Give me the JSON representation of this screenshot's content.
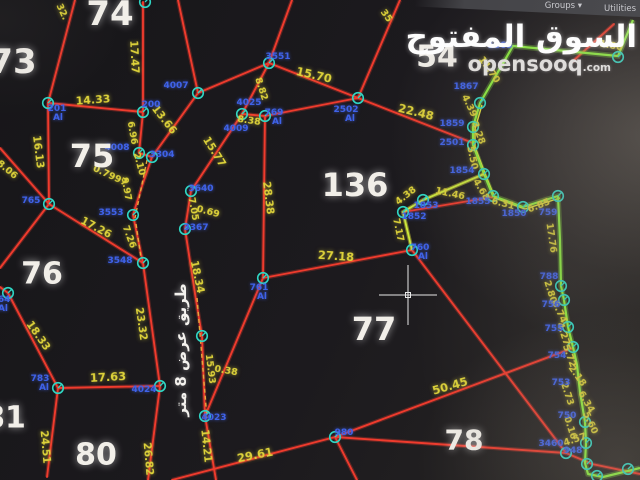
{
  "toolbar": {
    "groups_label": "Groups ▾",
    "utilities_label": "Utilities"
  },
  "watermark": {
    "arabic": "السوق المفتوح",
    "latin": "opensooq",
    "tld": ".com"
  },
  "colors": {
    "parcel_line": "#ef3b2d",
    "highlight_boundary": "#8df23e",
    "highlight_inner": "#e6e63a",
    "distance_label": "#ddd23a",
    "point_label": "#3f62e8",
    "point_marker": "#2fd6c4",
    "parcel_number": "#f2efe9",
    "road_dash": "#e8a83c",
    "crosshair": "#e8e8e8"
  },
  "map": {
    "road_label": {
      "t": "طريق عرض 8 متر",
      "x": 181,
      "y": 350,
      "size": 15
    },
    "crosshair": {
      "x": 408,
      "y": 295
    },
    "parcel_numbers": [
      {
        "t": "73",
        "x": 13,
        "y": 62,
        "s": 34
      },
      {
        "t": "74",
        "x": 110,
        "y": 14,
        "s": 34
      },
      {
        "t": "75",
        "x": 92,
        "y": 156,
        "s": 32
      },
      {
        "t": "76",
        "x": 42,
        "y": 274,
        "s": 30
      },
      {
        "t": "54",
        "x": 437,
        "y": 57,
        "s": 30
      },
      {
        "t": "136",
        "x": 355,
        "y": 185,
        "s": 32
      },
      {
        "t": "77",
        "x": 374,
        "y": 329,
        "s": 32
      },
      {
        "t": "78",
        "x": 464,
        "y": 440,
        "s": 28
      },
      {
        "t": "80",
        "x": 96,
        "y": 455,
        "s": 30
      },
      {
        "t": "81",
        "x": 5,
        "y": 418,
        "s": 30
      }
    ],
    "distance_labels": [
      {
        "t": "32.",
        "x": 62,
        "y": 12,
        "r": 65
      },
      {
        "t": "17.47",
        "x": 134,
        "y": 57,
        "r": 87,
        "s": 10.5
      },
      {
        "t": "14.33",
        "x": 93,
        "y": 100,
        "r": -4,
        "s": 11
      },
      {
        "t": "16.13",
        "x": 38,
        "y": 152,
        "r": 83,
        "s": 10.5
      },
      {
        "t": "8.06",
        "x": 7,
        "y": 170,
        "r": 40
      },
      {
        "t": "6.96",
        "x": 132,
        "y": 133,
        "r": 80
      },
      {
        "t": "2.10",
        "x": 139,
        "y": 164,
        "r": 75
      },
      {
        "t": "0.7997",
        "x": 110,
        "y": 176,
        "r": 25
      },
      {
        "t": "9.97",
        "x": 126,
        "y": 189,
        "r": 80
      },
      {
        "t": "13.66",
        "x": 164,
        "y": 120,
        "r": 52,
        "s": 10.5
      },
      {
        "t": "8.82",
        "x": 261,
        "y": 89,
        "r": 72
      },
      {
        "t": "15.70",
        "x": 314,
        "y": 75,
        "r": 13,
        "s": 11.5
      },
      {
        "t": "35",
        "x": 386,
        "y": 16,
        "r": 55
      },
      {
        "t": "22.48",
        "x": 416,
        "y": 112,
        "r": 14,
        "s": 11.5
      },
      {
        "t": "8.38",
        "x": 249,
        "y": 121,
        "r": 8
      },
      {
        "t": "15.77",
        "x": 214,
        "y": 152,
        "r": 58,
        "s": 10.5
      },
      {
        "t": "7.05",
        "x": 193,
        "y": 209,
        "r": 80
      },
      {
        "t": "0.69",
        "x": 208,
        "y": 212,
        "r": 15
      },
      {
        "t": "28.38",
        "x": 268,
        "y": 198,
        "r": 83,
        "s": 10.5
      },
      {
        "t": "17.26",
        "x": 96,
        "y": 228,
        "r": 28,
        "s": 10.5
      },
      {
        "t": "7.26",
        "x": 129,
        "y": 237,
        "r": 70
      },
      {
        "t": "18.33",
        "x": 38,
        "y": 336,
        "r": 55,
        "s": 10.5
      },
      {
        "t": "17.63",
        "x": 108,
        "y": 377,
        "r": -3,
        "s": 11.5
      },
      {
        "t": "24.51",
        "x": 45,
        "y": 447,
        "r": 85,
        "s": 10.5
      },
      {
        "t": "23.32",
        "x": 141,
        "y": 324,
        "r": 82,
        "s": 10.5
      },
      {
        "t": "26.82",
        "x": 148,
        "y": 459,
        "r": 85,
        "s": 10.5
      },
      {
        "t": "18.34",
        "x": 197,
        "y": 277,
        "r": 78,
        "s": 10.5
      },
      {
        "t": "15.93",
        "x": 210,
        "y": 369,
        "r": 83
      },
      {
        "t": "0.38",
        "x": 226,
        "y": 371,
        "r": 10
      },
      {
        "t": "14.21",
        "x": 206,
        "y": 446,
        "r": 84,
        "s": 10.5
      },
      {
        "t": "29.61",
        "x": 255,
        "y": 455,
        "r": -11,
        "s": 11.5
      },
      {
        "t": "27.18",
        "x": 336,
        "y": 256,
        "r": 4,
        "s": 11.5
      },
      {
        "t": "50.45",
        "x": 450,
        "y": 386,
        "r": -16,
        "s": 11.5
      },
      {
        "t": "11.70",
        "x": 489,
        "y": 70,
        "r": 55
      },
      {
        "t": "4.39",
        "x": 469,
        "y": 106,
        "r": 65
      },
      {
        "t": "3.28",
        "x": 478,
        "y": 133,
        "r": 70
      },
      {
        "t": "5.50",
        "x": 472,
        "y": 158,
        "r": 78
      },
      {
        "t": "4.68",
        "x": 481,
        "y": 190,
        "r": 60
      },
      {
        "t": "6.31",
        "x": 503,
        "y": 204,
        "r": 14
      },
      {
        "t": "6.85",
        "x": 539,
        "y": 206,
        "r": -22
      },
      {
        "t": "17.76",
        "x": 551,
        "y": 238,
        "r": 82
      },
      {
        "t": "11.46",
        "x": 450,
        "y": 194,
        "r": 12
      },
      {
        "t": "4.38",
        "x": 406,
        "y": 196,
        "r": -38
      },
      {
        "t": "7.17",
        "x": 398,
        "y": 230,
        "r": 78
      },
      {
        "t": "2.80",
        "x": 550,
        "y": 292,
        "r": 73
      },
      {
        "t": "6.74",
        "x": 559,
        "y": 312,
        "r": 65
      },
      {
        "t": "4.27",
        "x": 563,
        "y": 334,
        "r": 72
      },
      {
        "t": "5.72",
        "x": 569,
        "y": 356,
        "r": 70
      },
      {
        "t": "2.18",
        "x": 577,
        "y": 376,
        "r": 55
      },
      {
        "t": "2.73",
        "x": 567,
        "y": 394,
        "r": 72
      },
      {
        "t": "6.34",
        "x": 586,
        "y": 402,
        "r": 60
      },
      {
        "t": "5.60",
        "x": 590,
        "y": 423,
        "r": 65
      },
      {
        "t": "0.16",
        "x": 570,
        "y": 428,
        "r": 72
      },
      {
        "t": "4.57",
        "x": 575,
        "y": 440,
        "r": -18
      },
      {
        "t": "1.80",
        "x": 611,
        "y": 46,
        "r": 10
      }
    ],
    "point_labels": [
      {
        "t": "201",
        "x": 57,
        "y": 109
      },
      {
        "t": "Al",
        "x": 58,
        "y": 118
      },
      {
        "t": "200",
        "x": 151,
        "y": 105
      },
      {
        "t": "4007",
        "x": 176,
        "y": 86
      },
      {
        "t": "3551",
        "x": 278,
        "y": 57
      },
      {
        "t": "2502",
        "x": 346,
        "y": 110
      },
      {
        "t": "Al",
        "x": 350,
        "y": 119
      },
      {
        "t": "4025",
        "x": 249,
        "y": 103
      },
      {
        "t": "769",
        "x": 274,
        "y": 113
      },
      {
        "t": "Al",
        "x": 277,
        "y": 122
      },
      {
        "t": "4009",
        "x": 236,
        "y": 129
      },
      {
        "t": "3640",
        "x": 201,
        "y": 189
      },
      {
        "t": "3367",
        "x": 196,
        "y": 228
      },
      {
        "t": "4008",
        "x": 117,
        "y": 148
      },
      {
        "t": "3304",
        "x": 162,
        "y": 155
      },
      {
        "t": "3553",
        "x": 111,
        "y": 213
      },
      {
        "t": "3548",
        "x": 120,
        "y": 261
      },
      {
        "t": "765",
        "x": 31,
        "y": 201
      },
      {
        "t": "764",
        "x": 1,
        "y": 300
      },
      {
        "t": "Al",
        "x": 3,
        "y": 309
      },
      {
        "t": "761",
        "x": 259,
        "y": 288
      },
      {
        "t": "Al",
        "x": 262,
        "y": 297
      },
      {
        "t": "783",
        "x": 40,
        "y": 379
      },
      {
        "t": "Al",
        "x": 44,
        "y": 388
      },
      {
        "t": "4024",
        "x": 144,
        "y": 390
      },
      {
        "t": "4023",
        "x": 214,
        "y": 418
      },
      {
        "t": "980",
        "x": 344,
        "y": 433
      },
      {
        "t": "760",
        "x": 420,
        "y": 248
      },
      {
        "t": "Al",
        "x": 423,
        "y": 257
      },
      {
        "t": "2501",
        "x": 452,
        "y": 143
      },
      {
        "t": "1859",
        "x": 452,
        "y": 124
      },
      {
        "t": "1867",
        "x": 466,
        "y": 87
      },
      {
        "t": "1863",
        "x": 500,
        "y": 46
      },
      {
        "t": "1854",
        "x": 462,
        "y": 171
      },
      {
        "t": "1855",
        "x": 478,
        "y": 202
      },
      {
        "t": "1850",
        "x": 514,
        "y": 214
      },
      {
        "t": "759",
        "x": 548,
        "y": 213
      },
      {
        "t": "1853",
        "x": 426,
        "y": 206
      },
      {
        "t": "1852",
        "x": 414,
        "y": 217
      },
      {
        "t": "788",
        "x": 549,
        "y": 277
      },
      {
        "t": "756",
        "x": 551,
        "y": 305
      },
      {
        "t": "755",
        "x": 554,
        "y": 329
      },
      {
        "t": "754",
        "x": 557,
        "y": 356
      },
      {
        "t": "753",
        "x": 561,
        "y": 383
      },
      {
        "t": "750",
        "x": 567,
        "y": 416
      },
      {
        "t": "3460",
        "x": 551,
        "y": 444
      },
      {
        "t": "948",
        "x": 573,
        "y": 451
      }
    ],
    "markers": [
      [
        145,
        2
      ],
      [
        48,
        103
      ],
      [
        143,
        112
      ],
      [
        198,
        93
      ],
      [
        269,
        63
      ],
      [
        358,
        98
      ],
      [
        242,
        114
      ],
      [
        265,
        116
      ],
      [
        139,
        153
      ],
      [
        152,
        157
      ],
      [
        133,
        215
      ],
      [
        143,
        263
      ],
      [
        49,
        204
      ],
      [
        8,
        293
      ],
      [
        191,
        191
      ],
      [
        185,
        229
      ],
      [
        263,
        278
      ],
      [
        58,
        388
      ],
      [
        160,
        386
      ],
      [
        202,
        336
      ],
      [
        205,
        416
      ],
      [
        335,
        437
      ],
      [
        412,
        250
      ],
      [
        403,
        212
      ],
      [
        423,
        200
      ],
      [
        473,
        127
      ],
      [
        473,
        145
      ],
      [
        480,
        103
      ],
      [
        484,
        174
      ],
      [
        493,
        196
      ],
      [
        523,
        207
      ],
      [
        558,
        196
      ],
      [
        618,
        57
      ],
      [
        561,
        286
      ],
      [
        564,
        300
      ],
      [
        568,
        327
      ],
      [
        573,
        347
      ],
      [
        585,
        422
      ],
      [
        586,
        443
      ],
      [
        566,
        453
      ],
      [
        587,
        464
      ],
      [
        597,
        476
      ],
      [
        628,
        469
      ]
    ],
    "red_lines": [
      [
        [
          75,
          0
        ],
        [
          48,
          103
        ]
      ],
      [
        [
          48,
          103
        ],
        [
          143,
          112
        ]
      ],
      [
        [
          48,
          103
        ],
        [
          49,
          204
        ]
      ],
      [
        [
          0,
          148
        ],
        [
          49,
          204
        ]
      ],
      [
        [
          49,
          204
        ],
        [
          0,
          268
        ]
      ],
      [
        [
          49,
          204
        ],
        [
          143,
          263
        ]
      ],
      [
        [
          143,
          2
        ],
        [
          143,
          112
        ]
      ],
      [
        [
          143,
          112
        ],
        [
          139,
          153
        ]
      ],
      [
        [
          139,
          153
        ],
        [
          152,
          157
        ]
      ],
      [
        [
          152,
          157
        ],
        [
          142,
          186
        ],
        [
          133,
          215
        ]
      ],
      [
        [
          133,
          215
        ],
        [
          143,
          263
        ]
      ],
      [
        [
          143,
          263
        ],
        [
          160,
          386
        ]
      ],
      [
        [
          160,
          386
        ],
        [
          148,
          480
        ]
      ],
      [
        [
          152,
          157
        ],
        [
          198,
          93
        ]
      ],
      [
        [
          198,
          93
        ],
        [
          178,
          0
        ]
      ],
      [
        [
          198,
          93
        ],
        [
          269,
          63
        ]
      ],
      [
        [
          269,
          63
        ],
        [
          292,
          0
        ]
      ],
      [
        [
          269,
          63
        ],
        [
          242,
          114
        ]
      ],
      [
        [
          242,
          114
        ],
        [
          191,
          191
        ]
      ],
      [
        [
          191,
          191
        ],
        [
          185,
          229
        ]
      ],
      [
        [
          185,
          229
        ],
        [
          196,
          300
        ],
        [
          202,
          336
        ],
        [
          205,
          416
        ]
      ],
      [
        [
          205,
          416
        ],
        [
          216,
          480
        ]
      ],
      [
        [
          242,
          114
        ],
        [
          265,
          116
        ]
      ],
      [
        [
          265,
          116
        ],
        [
          263,
          278
        ]
      ],
      [
        [
          265,
          116
        ],
        [
          358,
          98
        ]
      ],
      [
        [
          269,
          63
        ],
        [
          358,
          98
        ]
      ],
      [
        [
          358,
          98
        ],
        [
          400,
          0
        ]
      ],
      [
        [
          358,
          98
        ],
        [
          473,
          143
        ]
      ],
      [
        [
          263,
          278
        ],
        [
          412,
          250
        ]
      ],
      [
        [
          263,
          278
        ],
        [
          205,
          416
        ]
      ],
      [
        [
          8,
          293
        ],
        [
          58,
          388
        ]
      ],
      [
        [
          58,
          388
        ],
        [
          160,
          386
        ]
      ],
      [
        [
          58,
          388
        ],
        [
          47,
          477
        ]
      ],
      [
        [
          0,
          287
        ],
        [
          8,
          293
        ]
      ],
      [
        [
          172,
          480
        ],
        [
          335,
          437
        ]
      ],
      [
        [
          335,
          437
        ],
        [
          357,
          480
        ]
      ],
      [
        [
          335,
          437
        ],
        [
          573,
          348
        ]
      ],
      [
        [
          335,
          437
        ],
        [
          566,
          453
        ]
      ],
      [
        [
          412,
          250
        ],
        [
          566,
          453
        ]
      ],
      [
        [
          566,
          453
        ],
        [
          592,
          464
        ],
        [
          640,
          474
        ]
      ],
      [
        [
          403,
          212
        ],
        [
          493,
          197
        ]
      ],
      [
        [
          614,
          24
        ],
        [
          572,
          62
        ]
      ]
    ],
    "green_path": [
      [
        633,
        20
      ],
      [
        618,
        56
      ],
      [
        513,
        46
      ],
      [
        480,
        103
      ],
      [
        473,
        127
      ],
      [
        473,
        145
      ],
      [
        484,
        174
      ],
      [
        493,
        196
      ],
      [
        523,
        207
      ],
      [
        558,
        196
      ],
      [
        560,
        240
      ],
      [
        561,
        286
      ],
      [
        564,
        300
      ],
      [
        568,
        327
      ],
      [
        573,
        347
      ],
      [
        577,
        365
      ],
      [
        580,
        392
      ],
      [
        585,
        422
      ],
      [
        586,
        443
      ],
      [
        585,
        463
      ],
      [
        588,
        474
      ],
      [
        603,
        477
      ],
      [
        640,
        468
      ]
    ],
    "green_inner": [
      [
        480,
        103
      ],
      [
        473,
        127
      ],
      [
        473,
        145
      ],
      [
        484,
        174
      ],
      [
        493,
        196
      ],
      [
        523,
        207
      ],
      [
        558,
        196
      ]
    ],
    "branch_path": [
      [
        484,
        174
      ],
      [
        423,
        200
      ],
      [
        403,
        212
      ],
      [
        412,
        250
      ]
    ],
    "dashed_lines": [
      [
        [
          147,
          160
        ],
        [
          135,
          218
        ]
      ],
      [
        [
          136,
          224
        ],
        [
          141,
          258
        ]
      ],
      [
        [
          197,
          298
        ],
        [
          207,
          418
        ]
      ]
    ]
  }
}
